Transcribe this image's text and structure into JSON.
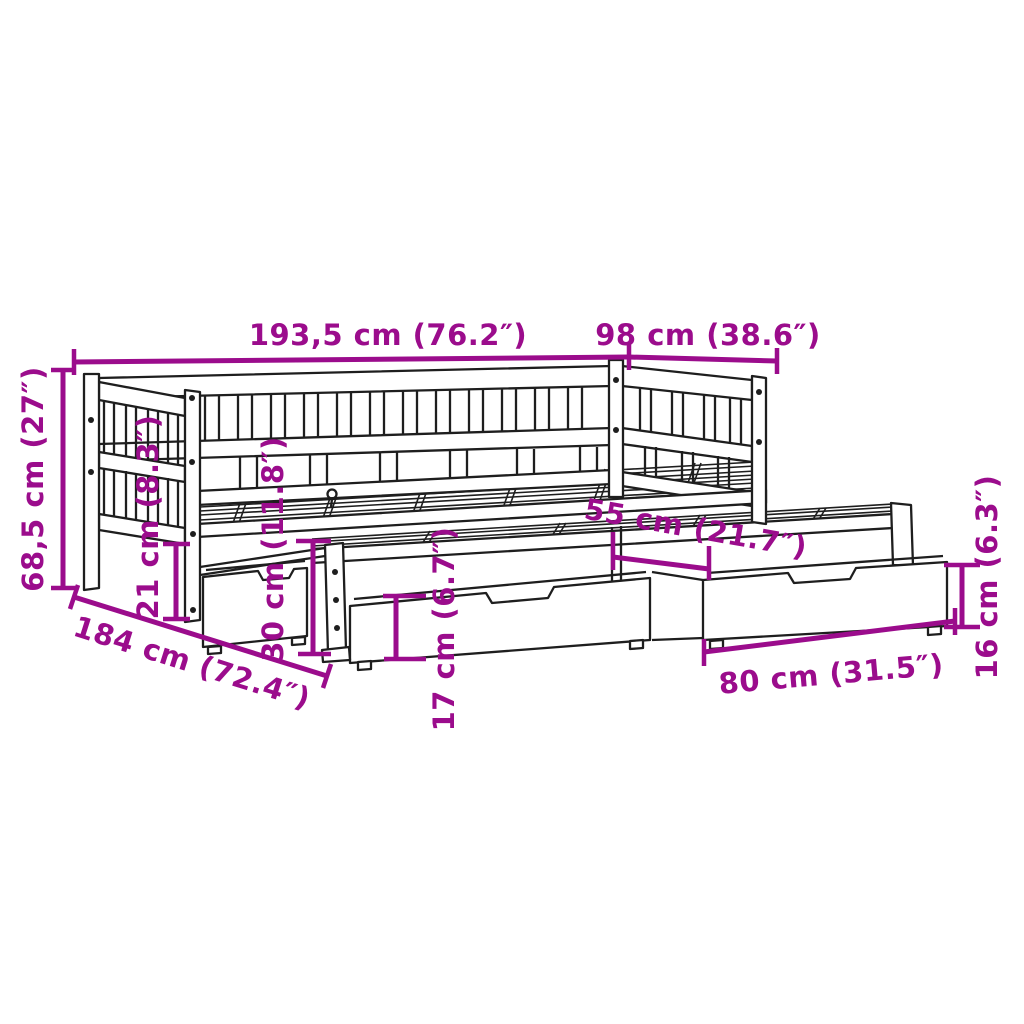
{
  "diagram": {
    "subject": "daybed-with-pullout-trundle-and-storage-drawers-dimension-diagram",
    "style": "technical line drawing, perspective view",
    "accent_color": "#9B0C8C",
    "line_color": "#1E1E1E",
    "background_color": "#FFFFFF",
    "dimensions": {
      "total_length": {
        "label": "193,5 cm (76.2″)",
        "value_cm": "193,5",
        "value_in": "76.2"
      },
      "total_depth": {
        "label": "98 cm (38.6″)",
        "value_cm": "98",
        "value_in": "38.6"
      },
      "total_height": {
        "label": "68,5 cm (27″)",
        "value_cm": "68,5",
        "value_in": "27"
      },
      "under_bed_clearance": {
        "label": "21 cm (8.3″)",
        "value_cm": "21",
        "value_in": "8.3"
      },
      "trundle_height": {
        "label": "30 cm (11.8″)",
        "value_cm": "30",
        "value_in": "11.8"
      },
      "trundle_depth": {
        "label": "55 cm (21.7″)",
        "value_cm": "55",
        "value_in": "21.7"
      },
      "drawer_front_height": {
        "label": "17 cm (6.7″)",
        "value_cm": "17",
        "value_in": "6.7"
      },
      "inner_length": {
        "label": "184 cm (72.4″)",
        "value_cm": "184",
        "value_in": "72.4"
      },
      "drawer_length": {
        "label": "80 cm (31.5″)",
        "value_cm": "80",
        "value_in": "31.5"
      },
      "drawer_height": {
        "label": "16 cm (6.3″)",
        "value_cm": "16",
        "value_in": "6.3"
      }
    }
  }
}
